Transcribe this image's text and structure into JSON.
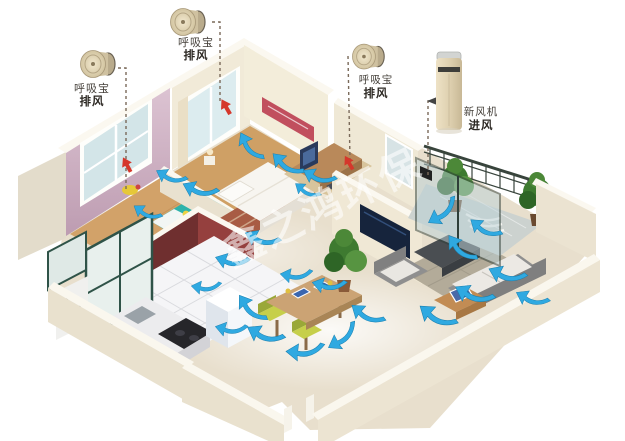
{
  "scene": {
    "type": "3d-isometric-apartment-ventilation-diagram",
    "watermark": "鑫之鸿环保",
    "background_color": "#ffffff"
  },
  "devices": [
    {
      "id": "exhaust-unit-1",
      "product": "呼吸宝",
      "function": "排风",
      "form": "round-wall-exhaust-fan",
      "points_to": "child-bedroom-window-wall"
    },
    {
      "id": "exhaust-unit-2",
      "product": "呼吸宝",
      "function": "排风",
      "form": "round-wall-exhaust-fan",
      "points_to": "master-bedroom-window-wall"
    },
    {
      "id": "exhaust-unit-3",
      "product": "呼吸宝",
      "function": "排风",
      "form": "round-wall-exhaust-fan",
      "points_to": "study-wall"
    },
    {
      "id": "fresh-air-unit",
      "product": "新风机",
      "function": "进风",
      "form": "floor-standing-tower",
      "points_to": "balcony-glass-door"
    }
  ],
  "colors": {
    "airflow_arrow": "#2fa9e1",
    "airflow_arrow_edge": "#1a7fae",
    "exhaust_arrow": "#d5372b",
    "wall_cream": "#f0e9d7",
    "wall_top_white": "#fbf8f0",
    "wall_pink": "#c9a9bd",
    "wall_maroon": "#8a3a3a",
    "floor_wood": "#d0a066",
    "floor_tile": "#e8dfcd",
    "kitchen_tile": "#f5f5f7",
    "device_gold": "#ddcfae",
    "leader_line": "#7a6a5a",
    "watermark_white": "rgba(255,255,255,0.58)"
  }
}
